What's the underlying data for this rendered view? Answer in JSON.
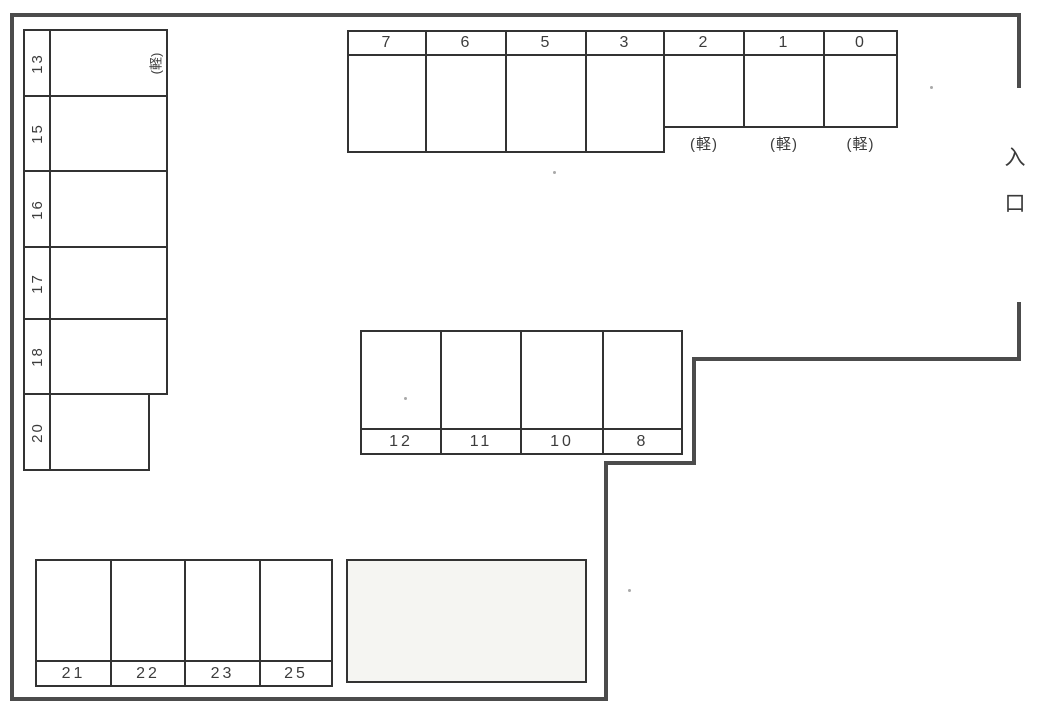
{
  "entrance": {
    "label": "入口"
  },
  "left_column": {
    "rows": [
      {
        "label": "13",
        "kei": "(軽)"
      },
      {
        "label": "15"
      },
      {
        "label": "16"
      },
      {
        "label": "17"
      },
      {
        "label": "18"
      },
      {
        "label": "20"
      }
    ]
  },
  "top_row": {
    "cells": [
      {
        "label": "7"
      },
      {
        "label": "6"
      },
      {
        "label": "5"
      },
      {
        "label": "3"
      },
      {
        "label": "2",
        "kei": "(軽)"
      },
      {
        "label": "1",
        "kei": "(軽)"
      },
      {
        "label": "0",
        "kei": "(軽)"
      }
    ]
  },
  "middle_row": {
    "cells": [
      {
        "label": "12"
      },
      {
        "label": "11"
      },
      {
        "label": "10"
      },
      {
        "label": "8"
      }
    ]
  },
  "bottom_row": {
    "cells": [
      {
        "label": "21"
      },
      {
        "label": "22"
      },
      {
        "label": "23"
      },
      {
        "label": "25"
      }
    ]
  },
  "colors": {
    "paper": "#ffffff",
    "thin_line": "#333333",
    "boundary_wall": "#4c4c4c",
    "text": "#3c3c3c"
  }
}
